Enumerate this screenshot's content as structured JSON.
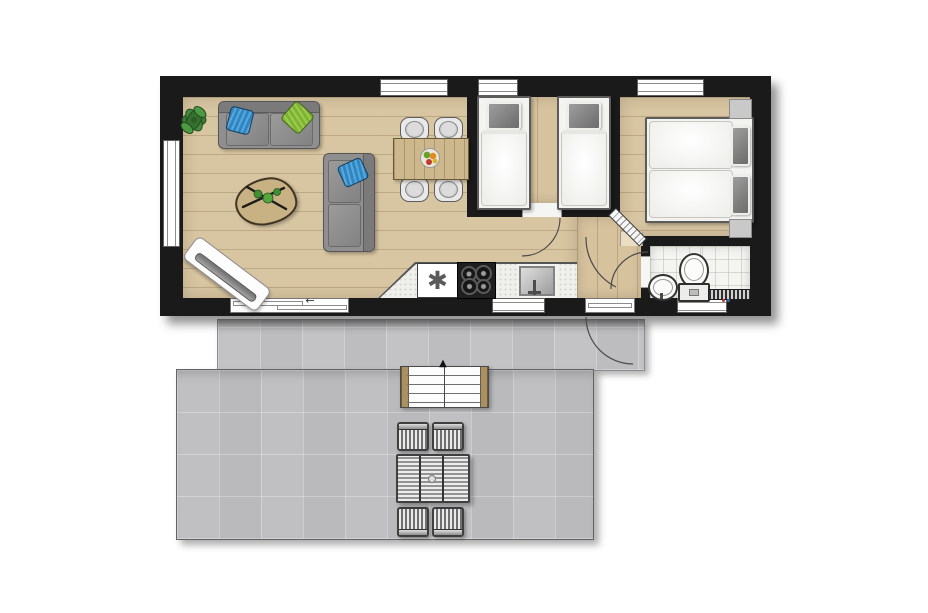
{
  "plan": {
    "type": "floor-plan",
    "description": "top-down floor plan of a small holiday home with twin bedroom, double bedroom, bathroom, open living-kitchen area and a two-level terrace with stairs and outdoor seating",
    "glyphs": {
      "dishwasher": "✱",
      "stairs_direction": "▲",
      "sliding_door_direction": "←"
    },
    "palette": {
      "wall": "#1a1a1a",
      "wood_floor": "#d8c5a1",
      "terrace_concrete": "#c6c6c8",
      "bathroom_tile": "#f4f4f1",
      "upholstery_gray": "#8f8f8f",
      "pillow_blue": "#2f86c4",
      "pillow_green": "#7eb431",
      "plant_green": "#3a7c35",
      "table_wood": "#cdb88d"
    },
    "rooms": [
      {
        "name": "living-room",
        "furniture": [
          "sofa with blue and green pillows",
          "lounge sofa with blue pillow",
          "coffee table with twigs decor",
          "potted plant",
          "white board bench"
        ]
      },
      {
        "name": "dining-area",
        "furniture": [
          "wooden dining table",
          "four chairs",
          "fruit bowl"
        ]
      },
      {
        "name": "kitchen",
        "furniture": [
          "dishwasher",
          "four-burner gas hob",
          "sink with faucet",
          "speckled counter"
        ]
      },
      {
        "name": "bedroom-twin",
        "furniture": [
          "single bed",
          "single bed"
        ]
      },
      {
        "name": "bedroom-double",
        "furniture": [
          "double bed",
          "nightstand",
          "nightstand"
        ]
      },
      {
        "name": "bathroom",
        "furniture": [
          "washbasin",
          "toilet",
          "radiator"
        ]
      },
      {
        "name": "terrace-upper",
        "furniture": []
      },
      {
        "name": "terrace-lower",
        "furniture": [
          "wide stairs",
          "outdoor table",
          "four outdoor chairs"
        ]
      }
    ],
    "openings": {
      "top_wall_windows": 3,
      "left_wall_windows": 1,
      "bottom_wall_windows": 2,
      "sliding_door": 1,
      "entry_door": 1,
      "interior_doors": 3
    }
  }
}
